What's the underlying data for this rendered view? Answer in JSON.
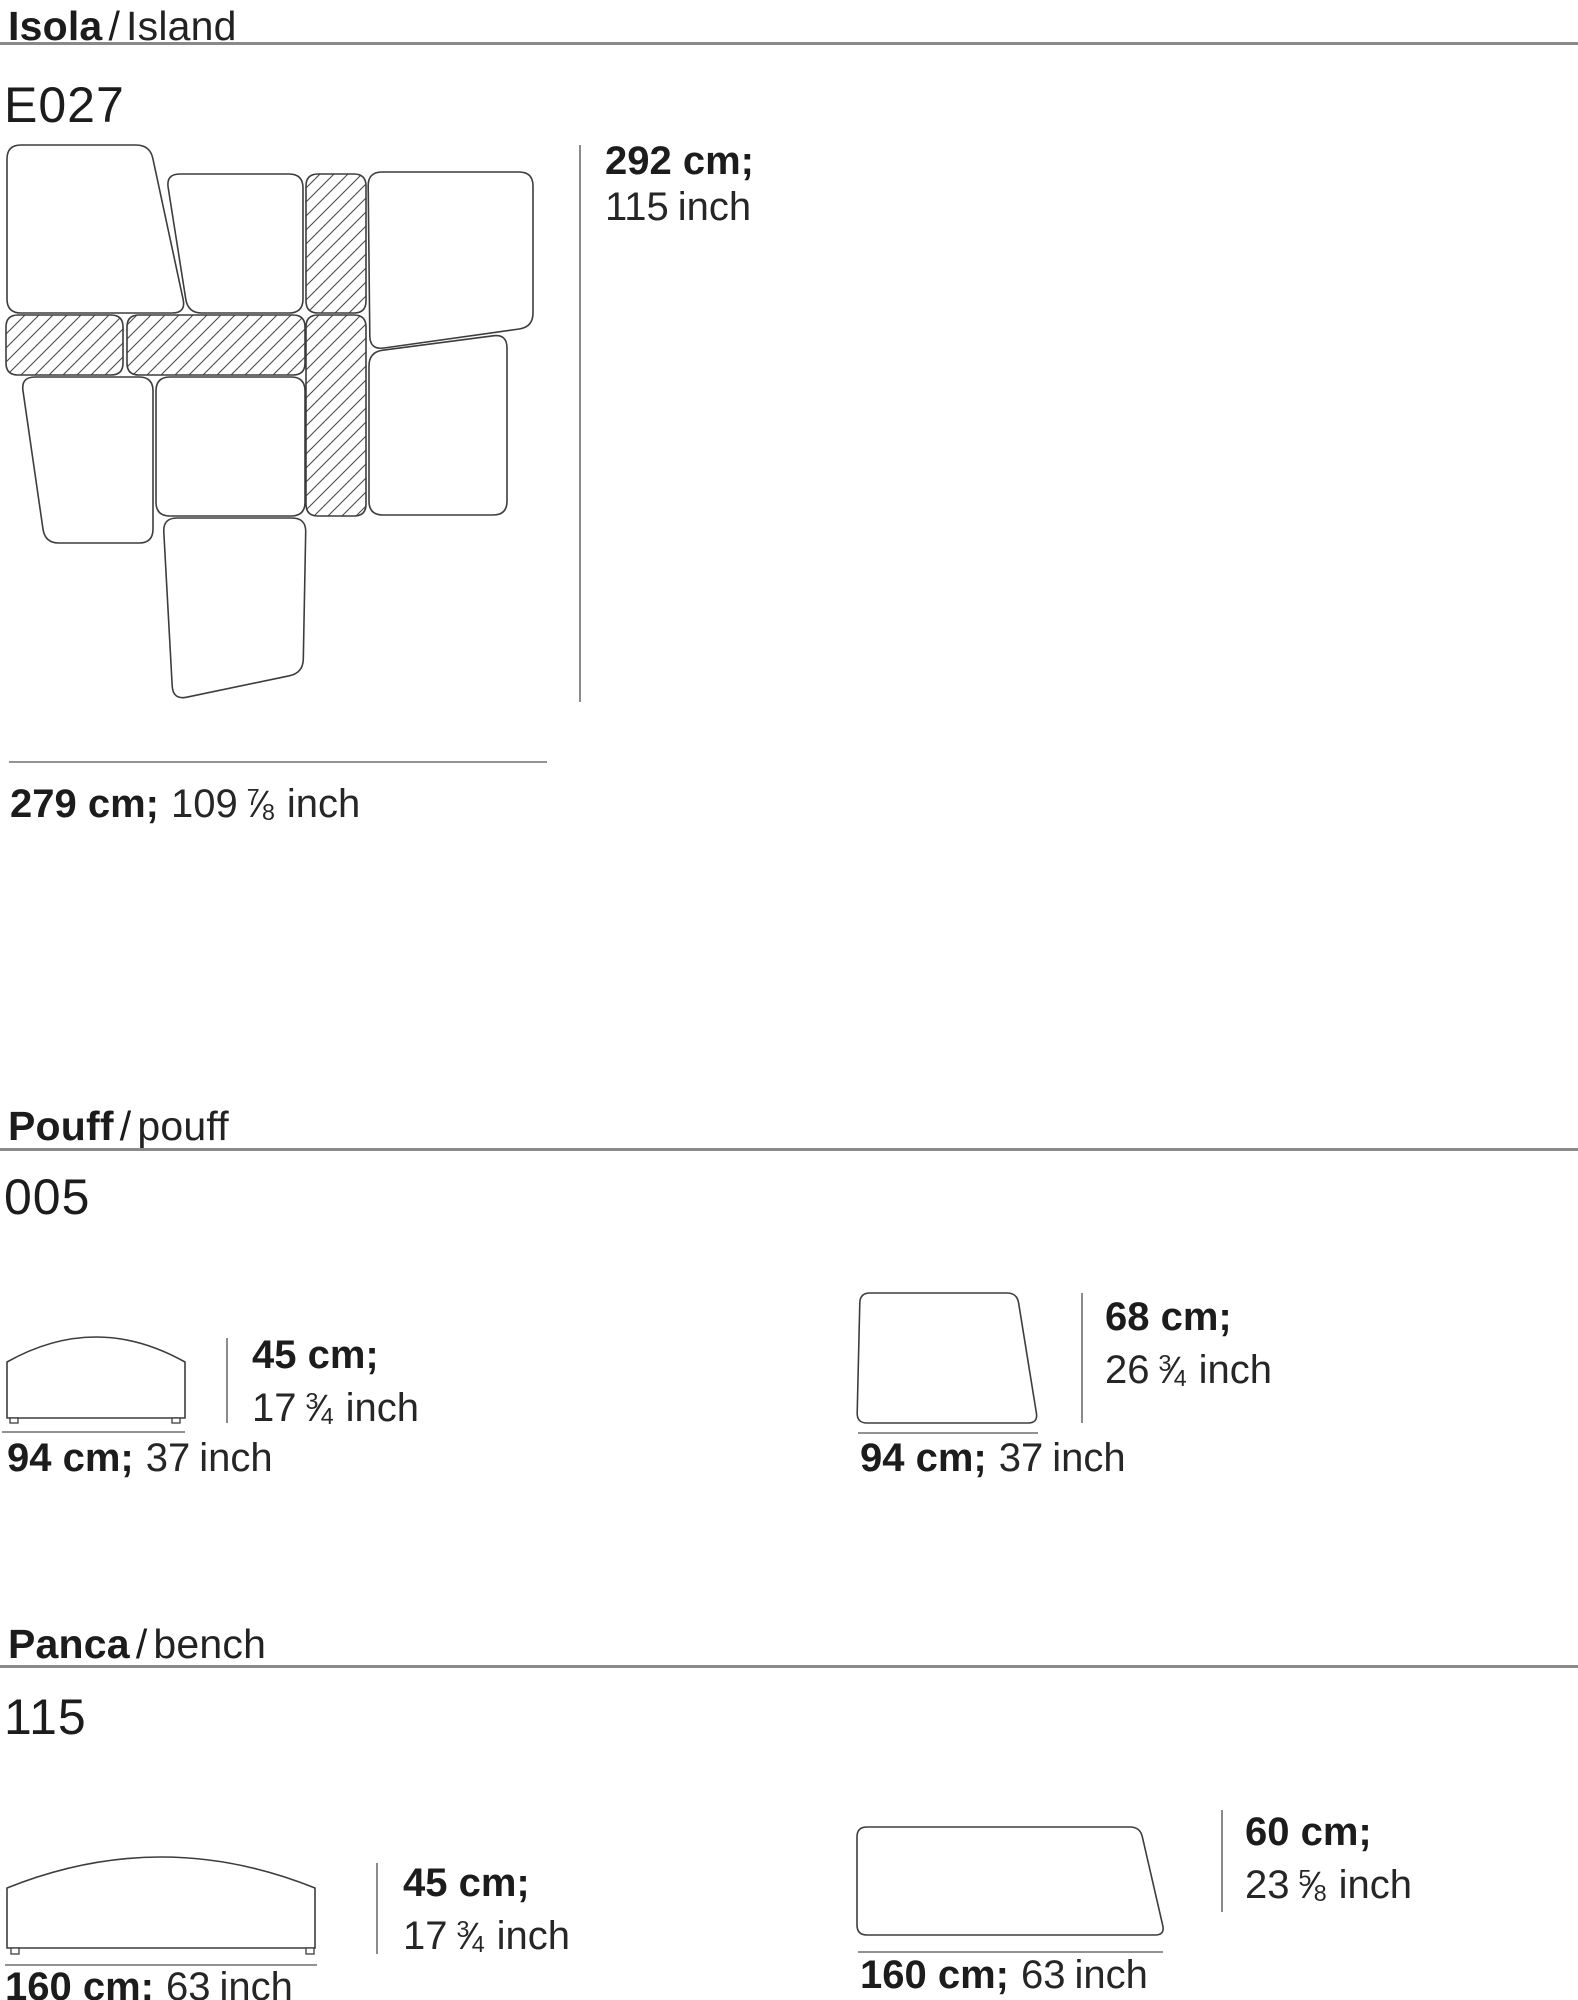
{
  "colors": {
    "text": "#1c1c1c",
    "rule": "#8a8a8a",
    "drawing_stroke": "#3d3d3d",
    "dimension_line": "#6e6e6e",
    "background": "#ffffff"
  },
  "sections": {
    "island": {
      "title_primary": "Isola",
      "title_sep": "/",
      "title_secondary": "Island",
      "code": "E027",
      "dims": {
        "height": {
          "cm": "292 cm;",
          "in_pre": "115",
          "frac_n": "",
          "frac_d": "",
          "in_post": "inch"
        },
        "width": {
          "cm": "279 cm;",
          "in_pre": "109",
          "frac_n": "7",
          "frac_d": "8",
          "in_post": "inch"
        }
      }
    },
    "pouff": {
      "title_primary": "Pouff",
      "title_sep": "/",
      "title_secondary": "pouff",
      "code": "005",
      "front": {
        "height": {
          "cm": "45 cm;",
          "in_pre": "17",
          "frac_n": "3",
          "frac_d": "4",
          "in_post": "inch"
        },
        "width": {
          "cm": "94 cm;",
          "in_pre": "37",
          "frac_n": "",
          "frac_d": "",
          "in_post": "inch"
        }
      },
      "side": {
        "height": {
          "cm": "68 cm;",
          "in_pre": "26",
          "frac_n": "3",
          "frac_d": "4",
          "in_post": "inch"
        },
        "width": {
          "cm": "94 cm;",
          "in_pre": "37",
          "frac_n": "",
          "frac_d": "",
          "in_post": "inch"
        }
      }
    },
    "bench": {
      "title_primary": "Panca",
      "title_sep": "/",
      "title_secondary": "bench",
      "code": "115",
      "front": {
        "height": {
          "cm": "45 cm;",
          "in_pre": "17",
          "frac_n": "3",
          "frac_d": "4",
          "in_post": "inch"
        },
        "width": {
          "cm": "160 cm;",
          "in_pre": "63",
          "frac_n": "",
          "frac_d": "",
          "in_post": "inch"
        }
      },
      "side": {
        "height": {
          "cm": "60 cm;",
          "in_pre": "23",
          "frac_n": "5",
          "frac_d": "8",
          "in_post": "inch"
        },
        "width": {
          "cm": "160 cm;",
          "in_pre": "63",
          "frac_n": "",
          "frac_d": "",
          "in_post": "inch"
        }
      }
    }
  },
  "drawings": {
    "island": {
      "shapes": [
        {
          "pts": [
            [
              7,
              15
            ],
            [
              150,
              15
            ],
            [
              186,
              183
            ],
            [
              7,
              183
            ]
          ],
          "r": 14
        },
        {
          "pts": [
            [
              166,
              44
            ],
            [
              303,
              44
            ],
            [
              303,
              183
            ],
            [
              188,
              183
            ]
          ],
          "r": 14
        },
        {
          "pts": [
            [
              306,
              44
            ],
            [
              366,
              44
            ],
            [
              366,
              183
            ],
            [
              306,
              183
            ]
          ],
          "r": 12,
          "hatch": true
        },
        {
          "pts": [
            [
              368,
              42
            ],
            [
              533,
              42
            ],
            [
              533,
              197
            ],
            [
              370,
              220
            ]
          ],
          "r": 14
        },
        {
          "pts": [
            [
              6,
              185
            ],
            [
              123,
              185
            ],
            [
              123,
              245
            ],
            [
              6,
              245
            ]
          ],
          "r": 12,
          "hatch": true
        },
        {
          "pts": [
            [
              127,
              185
            ],
            [
              305,
              185
            ],
            [
              305,
              245
            ],
            [
              127,
              245
            ]
          ],
          "r": 12,
          "hatch": true
        },
        {
          "pts": [
            [
              306,
              185
            ],
            [
              366,
              185
            ],
            [
              366,
              386
            ],
            [
              306,
              386
            ]
          ],
          "r": 12,
          "hatch": true
        },
        {
          "pts": [
            [
              21,
              247
            ],
            [
              153,
              247
            ],
            [
              153,
              413
            ],
            [
              45,
              413
            ]
          ],
          "r": 14
        },
        {
          "pts": [
            [
              156,
              247
            ],
            [
              305,
              247
            ],
            [
              305,
              386
            ],
            [
              156,
              386
            ]
          ],
          "r": 14
        },
        {
          "pts": [
            [
              369,
              222
            ],
            [
              507,
              204
            ],
            [
              507,
              385
            ],
            [
              369,
              385
            ]
          ],
          "r": 14
        },
        {
          "pts": [
            [
              163,
              388
            ],
            [
              306,
              388
            ],
            [
              303,
              543
            ],
            [
              173,
              570
            ]
          ],
          "r": 14
        }
      ],
      "feet": [],
      "lines": [
        {
          "x1": 580,
          "y1": 15,
          "x2": 580,
          "y2": 572
        },
        {
          "x1": 9,
          "y1": 632,
          "x2": 547,
          "y2": 632
        }
      ]
    },
    "pouff": {
      "shapes": [
        {
          "path": "M7,138 L7,82 Q96,32 185,82 L185,138 Z"
        },
        {
          "pts": [
            [
              860,
              13
            ],
            [
              1017,
              13
            ],
            [
              1038,
              143
            ],
            [
              857,
              143
            ]
          ],
          "r": 10
        }
      ],
      "feet": [
        {
          "x": 10,
          "y": 138,
          "w": 8,
          "h": 5
        },
        {
          "x": 172,
          "y": 138,
          "w": 8,
          "h": 5
        }
      ],
      "lines": [
        {
          "x1": 227,
          "y1": 58,
          "x2": 227,
          "y2": 143
        },
        {
          "x1": 2,
          "y1": 152,
          "x2": 185,
          "y2": 152
        },
        {
          "x1": 1082,
          "y1": 13,
          "x2": 1082,
          "y2": 143
        },
        {
          "x1": 858,
          "y1": 153,
          "x2": 1038,
          "y2": 153
        }
      ]
    },
    "bench": {
      "shapes": [
        {
          "path": "M7,158 L7,98 Q161,36 315,98 L315,158 Z"
        },
        {
          "pts": [
            [
              857,
              37
            ],
            [
              1140,
              37
            ],
            [
              1165,
              145
            ],
            [
              857,
              145
            ]
          ],
          "r": 10
        }
      ],
      "feet": [
        {
          "x": 11,
          "y": 158,
          "w": 8,
          "h": 6
        },
        {
          "x": 306,
          "y": 158,
          "w": 8,
          "h": 6
        }
      ],
      "lines": [
        {
          "x1": 377,
          "y1": 73,
          "x2": 377,
          "y2": 164
        },
        {
          "x1": 5,
          "y1": 175,
          "x2": 317,
          "y2": 175
        },
        {
          "x1": 1222,
          "y1": 20,
          "x2": 1222,
          "y2": 122
        },
        {
          "x1": 858,
          "y1": 162,
          "x2": 1163,
          "y2": 162
        }
      ]
    }
  }
}
